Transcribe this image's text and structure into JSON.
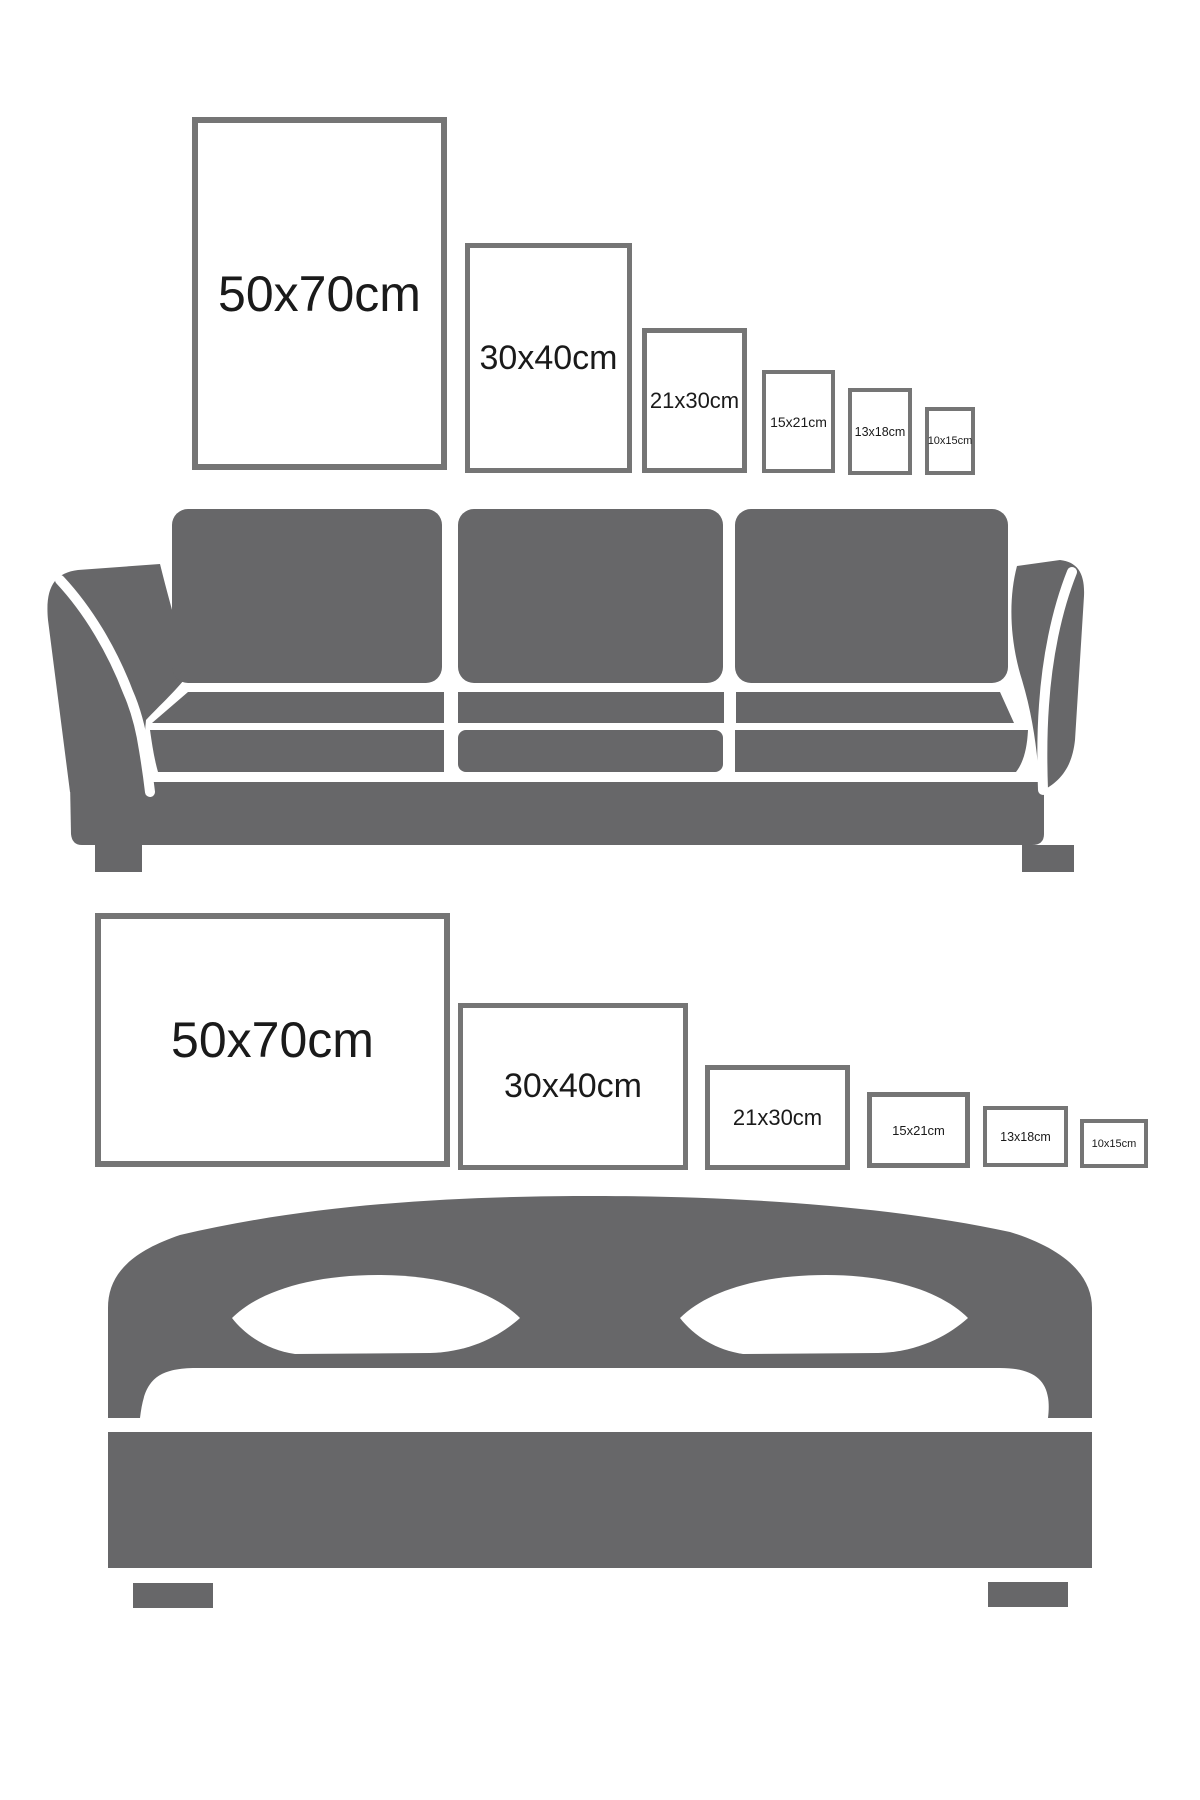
{
  "page": {
    "title": "Poster size guide — wall art sizes above sofa and bed",
    "width_px": 1200,
    "height_px": 1800,
    "background": "#ffffff"
  },
  "colors": {
    "furniture_gray": "#676769",
    "frame_border_gray": "#757575",
    "frame_fill": "#ffffff",
    "label_text": "#1a1a1a"
  },
  "sections": {
    "wall_above_sofa": {
      "furniture": "sofa",
      "orientation": "portrait",
      "frames": [
        {
          "label": "50x70cm",
          "width_cm": 50,
          "height_cm": 70,
          "x": 192,
          "y": 117,
          "w": 255,
          "h": 353,
          "border": 6,
          "font": 50
        },
        {
          "label": "30x40cm",
          "width_cm": 30,
          "height_cm": 40,
          "x": 465,
          "y": 243,
          "w": 167,
          "h": 230,
          "border": 5,
          "font": 34
        },
        {
          "label": "21x30cm",
          "width_cm": 21,
          "height_cm": 30,
          "x": 642,
          "y": 328,
          "w": 105,
          "h": 145,
          "border": 5,
          "font": 22
        },
        {
          "label": "15x21cm",
          "width_cm": 15,
          "height_cm": 21,
          "x": 762,
          "y": 370,
          "w": 73,
          "h": 103,
          "border": 4,
          "font": 14
        },
        {
          "label": "13x18cm",
          "width_cm": 13,
          "height_cm": 18,
          "x": 848,
          "y": 388,
          "w": 64,
          "h": 87,
          "border": 4,
          "font": 12.5
        },
        {
          "label": "10x15cm",
          "width_cm": 10,
          "height_cm": 15,
          "x": 925,
          "y": 407,
          "w": 50,
          "h": 68,
          "border": 4,
          "font": 11
        }
      ]
    },
    "wall_above_bed": {
      "furniture": "bed",
      "orientation": "landscape",
      "frames": [
        {
          "label": "50x70cm",
          "width_cm": 50,
          "height_cm": 70,
          "x": 95,
          "y": 913,
          "w": 355,
          "h": 254,
          "border": 6,
          "font": 50
        },
        {
          "label": "30x40cm",
          "width_cm": 30,
          "height_cm": 40,
          "x": 458,
          "y": 1003,
          "w": 230,
          "h": 167,
          "border": 5,
          "font": 34
        },
        {
          "label": "21x30cm",
          "width_cm": 21,
          "height_cm": 30,
          "x": 705,
          "y": 1065,
          "w": 145,
          "h": 105,
          "border": 5,
          "font": 22
        },
        {
          "label": "15x21cm",
          "width_cm": 15,
          "height_cm": 21,
          "x": 867,
          "y": 1092,
          "w": 103,
          "h": 76,
          "border": 5,
          "font": 13
        },
        {
          "label": "13x18cm",
          "width_cm": 13,
          "height_cm": 18,
          "x": 983,
          "y": 1106,
          "w": 85,
          "h": 61,
          "border": 4,
          "font": 12.5
        },
        {
          "label": "10x15cm",
          "width_cm": 10,
          "height_cm": 15,
          "x": 1080,
          "y": 1119,
          "w": 68,
          "h": 49,
          "border": 4,
          "font": 11
        }
      ]
    }
  }
}
